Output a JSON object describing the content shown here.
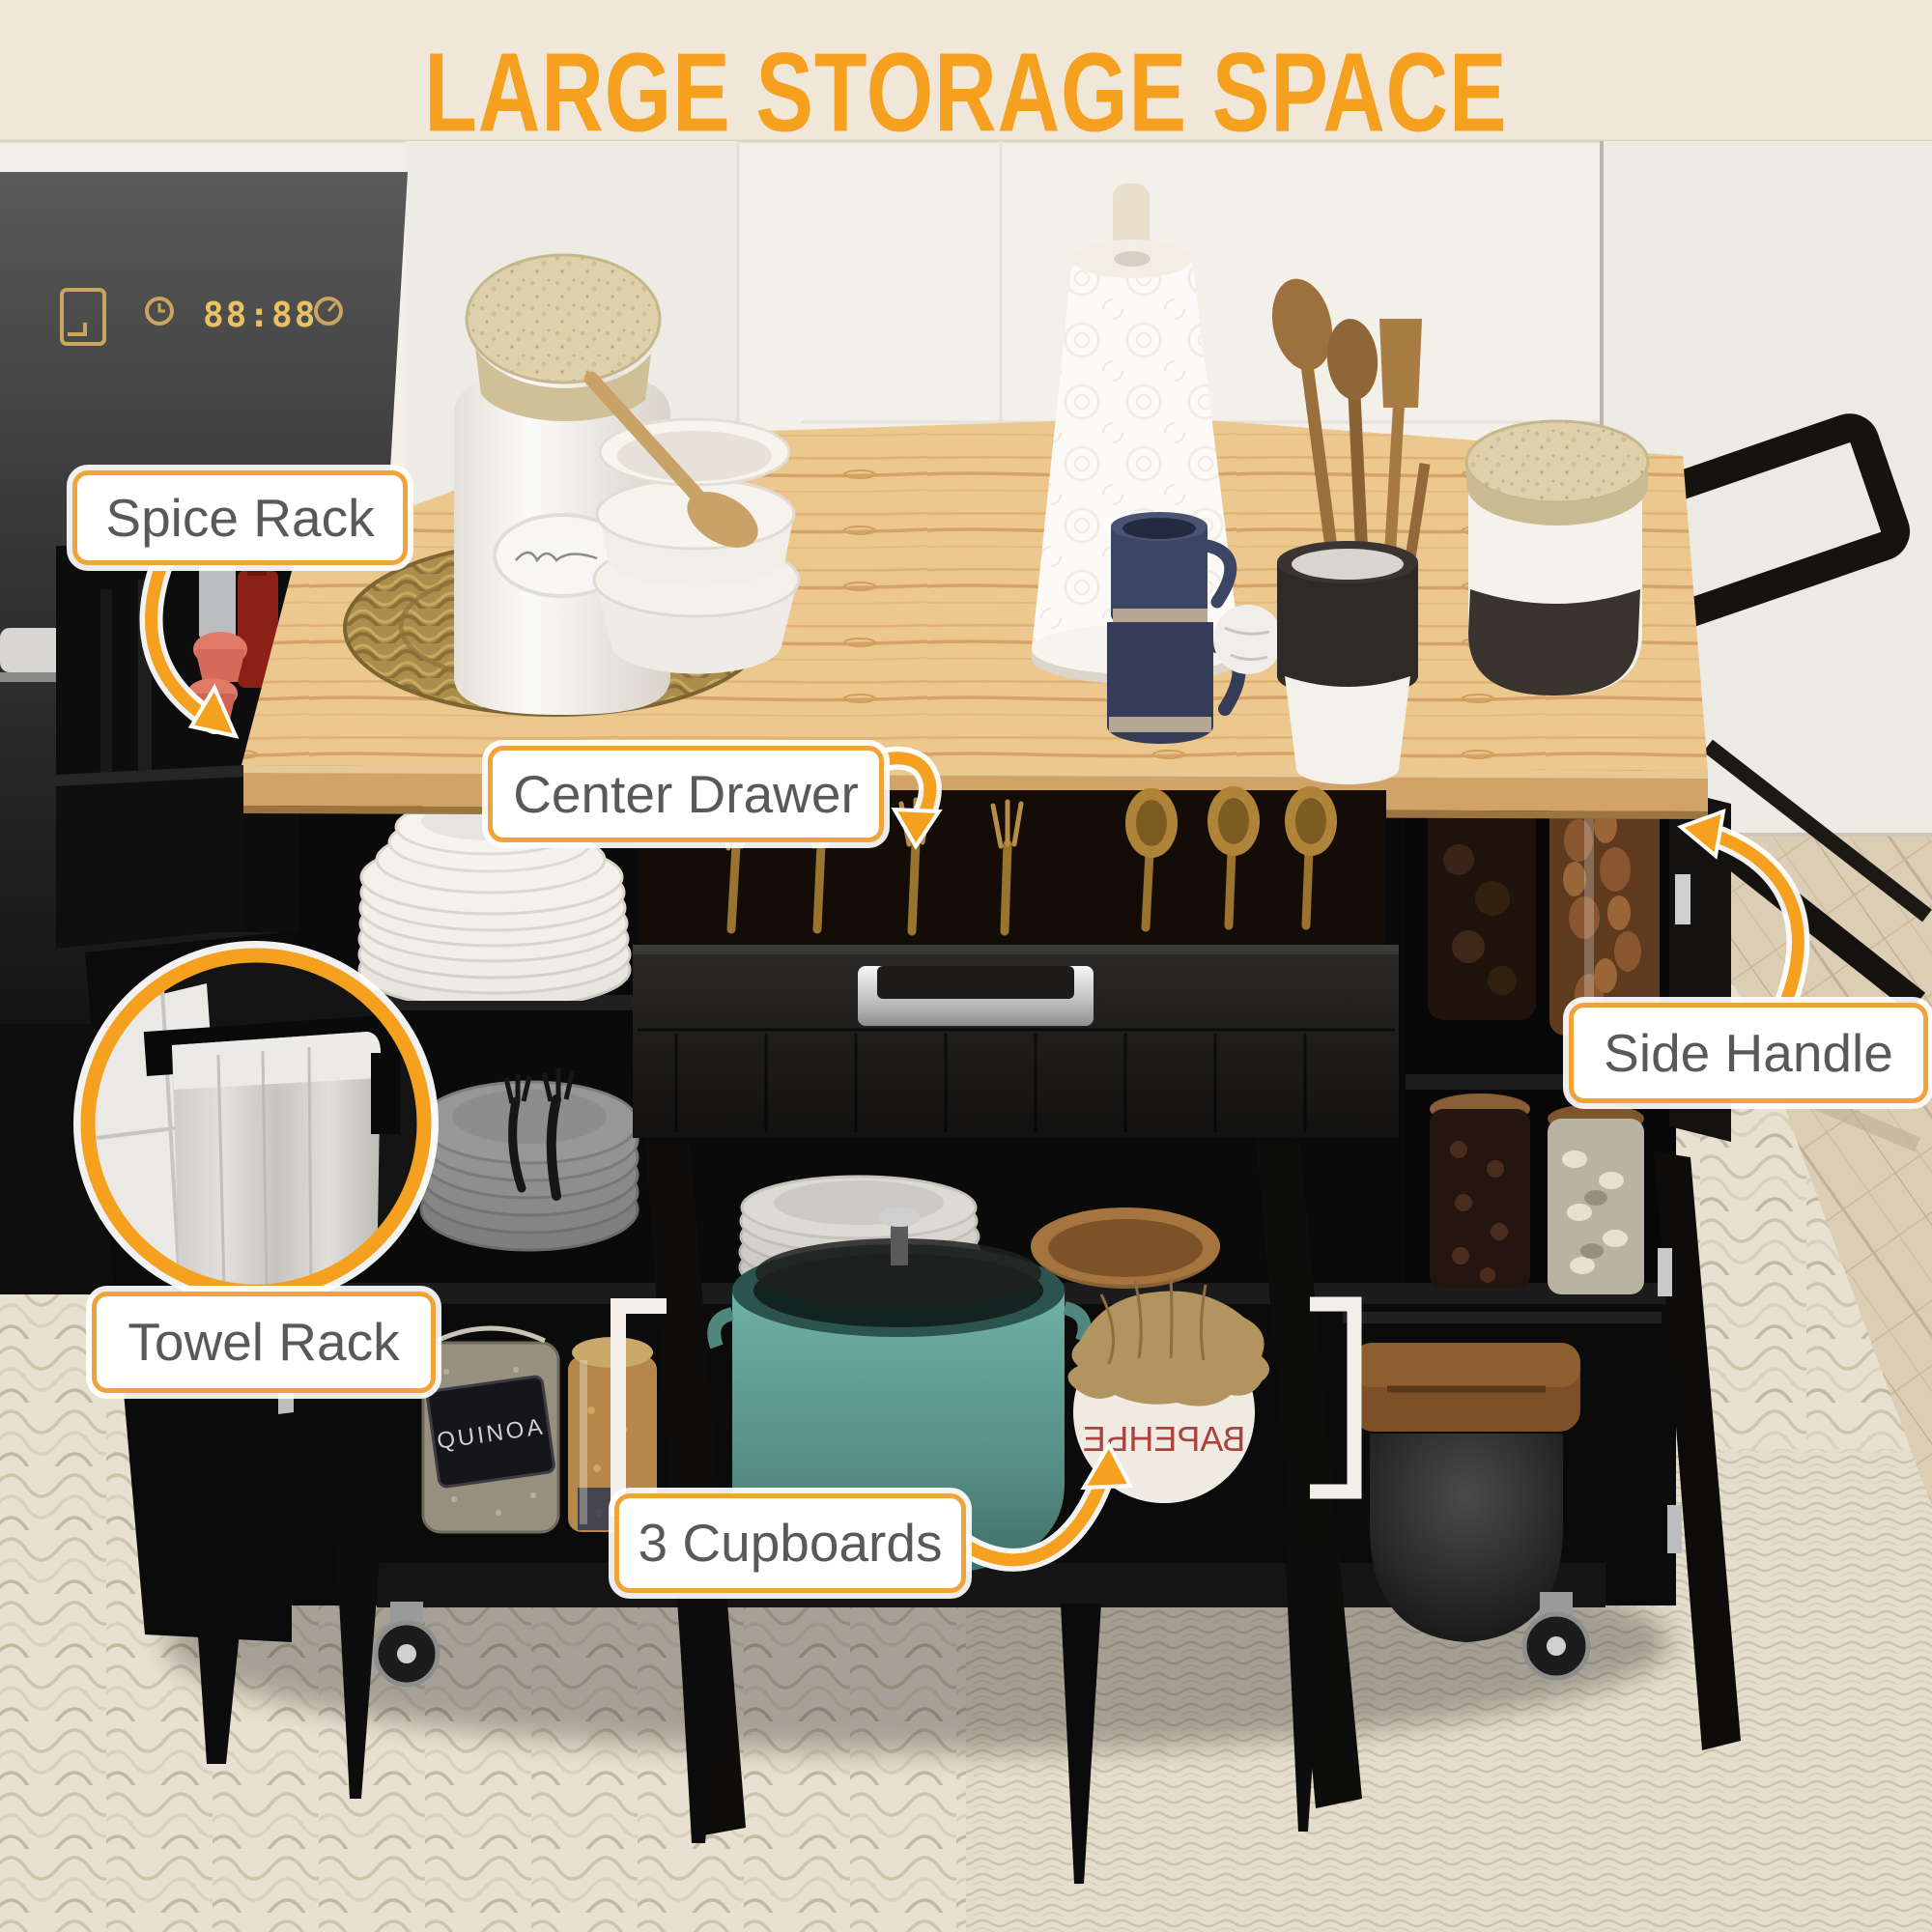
{
  "title": "LARGE STORAGE SPACE",
  "callouts": {
    "spice_rack": "Spice Rack",
    "center_drawer": "Center Drawer",
    "side_handle": "Side Handle",
    "towel_rack": "Towel Rack",
    "cupboards": "3 Cupboards"
  },
  "scene_text": {
    "oven_clock": "88:88",
    "quinoa_jar": "QUINOA",
    "jam_jar": "ВАРЕНЬЕ"
  },
  "colors": {
    "accent": "#F5A01E",
    "label_border": "#F0A339",
    "label_text": "#58595B",
    "wood_top": "#EAC389",
    "cart_black": "#141414",
    "teal_pot": "#5E9D94",
    "rug": "#E8E1D1",
    "wall": "#F3F0EA"
  }
}
